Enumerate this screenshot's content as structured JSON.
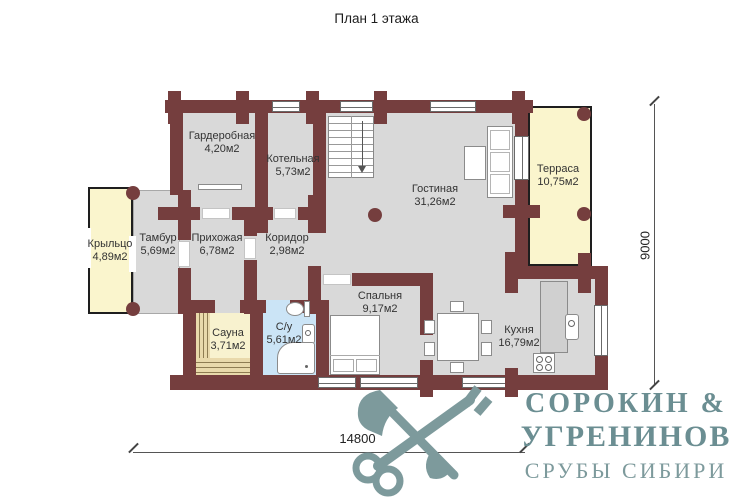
{
  "title": "План 1 этажа",
  "rooms": [
    {
      "name": "Гардеробная",
      "area": "4,20м2"
    },
    {
      "name": "Котельная",
      "area": "5,73м2"
    },
    {
      "name": "Гостиная",
      "area": "31,26м2"
    },
    {
      "name": "Терраса",
      "area": "10,75м2"
    },
    {
      "name": "Крыльцо",
      "area": "4,89м2"
    },
    {
      "name": "Тамбур",
      "area": "5,69м2"
    },
    {
      "name": "Прихожая",
      "area": "6,78м2"
    },
    {
      "name": "Коридор",
      "area": "2,98м2"
    },
    {
      "name": "С/у",
      "area": "5,61м2"
    },
    {
      "name": "Сауна",
      "area": "3,71м2"
    },
    {
      "name": "Спальня",
      "area": "9,17м2"
    },
    {
      "name": "Кухня",
      "area": "16,79м2"
    }
  ],
  "dimensions": {
    "width": "14800",
    "height": "9000"
  },
  "logo": {
    "icon": "crossed-axe-and-key",
    "brand_line1": "СОРОКИН &",
    "brand_line2": "УГРЕНИНОВ",
    "tagline": "СРУБЫ СИБИРИ"
  },
  "colors": {
    "wall": "#753e3e",
    "floor": "#d9d9d9",
    "terrace": "#faf5cd",
    "sauna_wood": "#e9d9ab",
    "bathroom": "#cbe4f6",
    "logo": "#7d9a9c",
    "logo_text": "#6b8e92"
  }
}
